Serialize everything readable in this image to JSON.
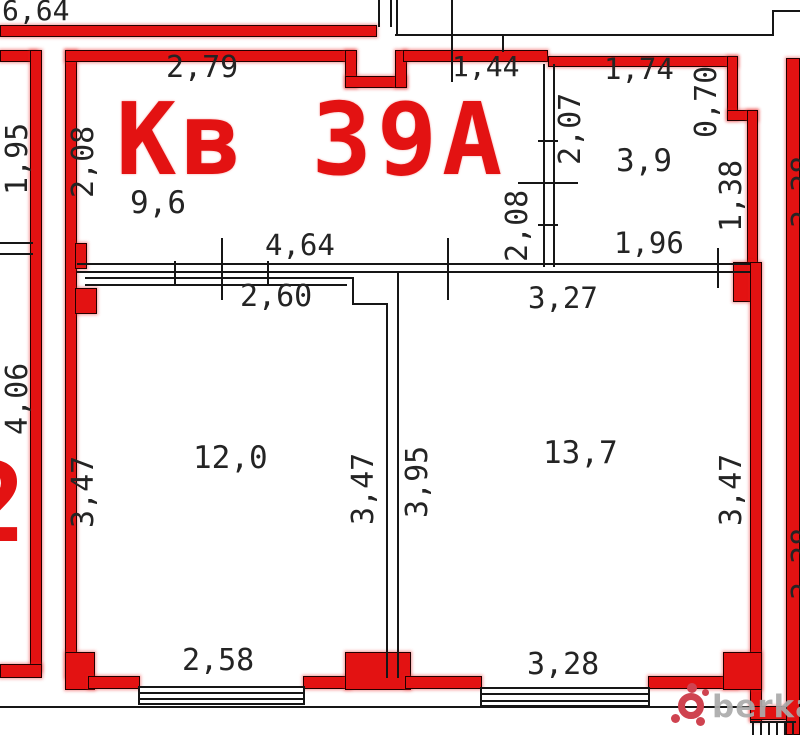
{
  "plan": {
    "title": "Кв 39А",
    "rooms": {
      "hall_area": "9,6",
      "bath_area": "3,9",
      "room1_area": "12,0",
      "room2_area": "13,7"
    },
    "dims": {
      "top_unit": "6,64",
      "hall_top": "2,79",
      "hall_top2": "1,44",
      "bath_top": "1,74",
      "bath_right_up": "0,70",
      "bath_left": "2,07",
      "bath_right_low": "1,38",
      "bath_bottom": "1,96",
      "hall_left": "2,08",
      "hall_mid": "2,08",
      "hall_bottom": "4,64",
      "room1_top": "2,60",
      "room2_top": "3,27",
      "left_unit_up": "1,95",
      "left_unit_low": "4,06",
      "room1_left": "3,47",
      "room1_right": "3,47",
      "room2_left": "3,95",
      "room2_right": "3,47",
      "right_unit_up": "3,38",
      "right_unit_low": "3,38",
      "room1_bottom": "2,58",
      "room2_bottom": "3,28"
    },
    "neighbor_fragment": "2",
    "watermark": {
      "brand": "berkat",
      "dot": "."
    }
  }
}
